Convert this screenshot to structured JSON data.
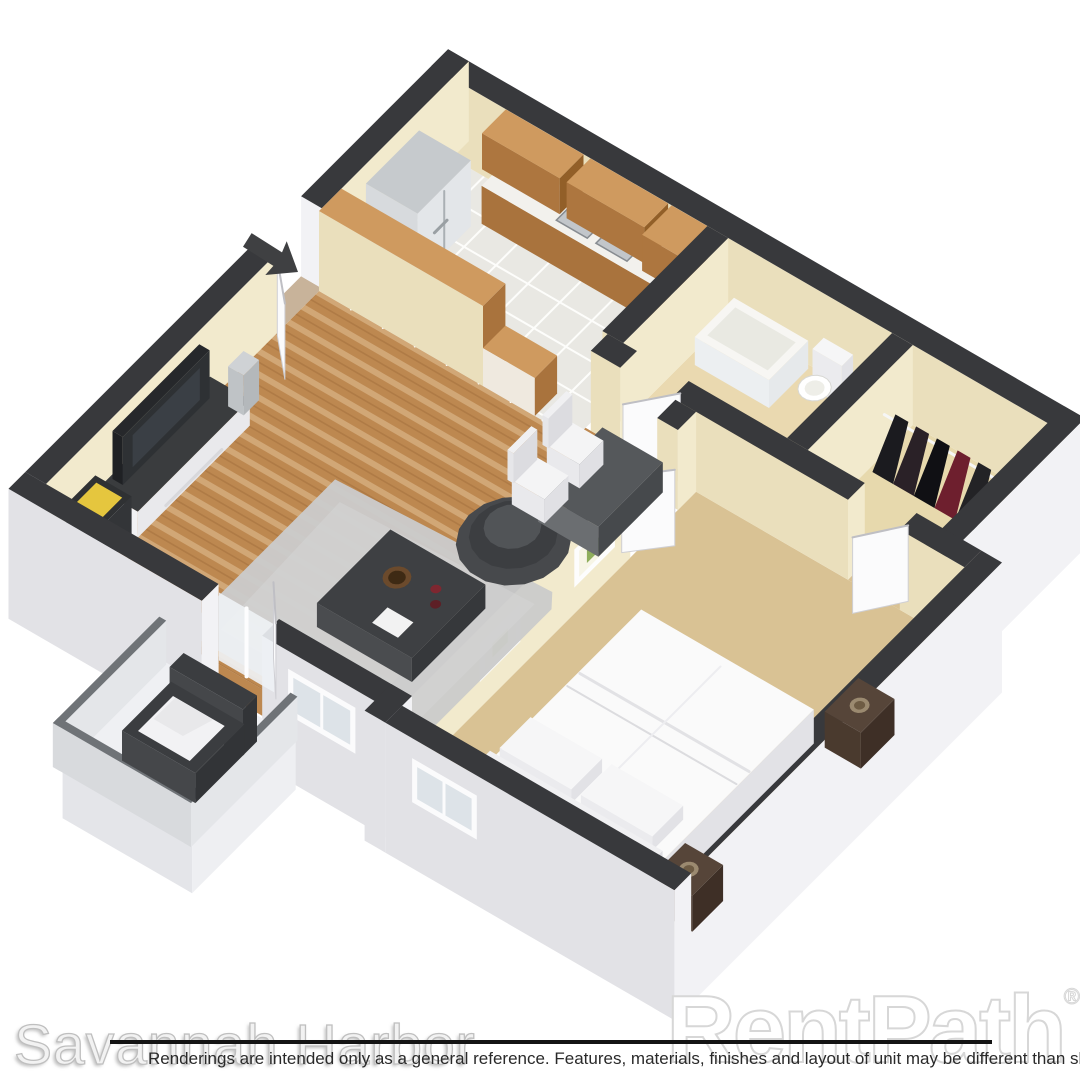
{
  "watermarks": {
    "property": "Savannah Harbor",
    "brand": "RentPath",
    "brand_mark": "®"
  },
  "disclaimer": "Renderings are intended only as a general reference. Features, materials, finishes and layout of unit may be different than shown.",
  "floorplan": {
    "type": "3d-isometric-floor-plan-rendering",
    "unit": "one-bedroom one-bath apartment",
    "rooms": [
      "kitchen",
      "dining-area",
      "living-room",
      "entry",
      "bathroom",
      "walk-in-closet",
      "bedroom",
      "balcony"
    ],
    "icons": [
      "entry-direction-arrow"
    ],
    "colors": {
      "background": "#ffffff",
      "wall_top": "#38393c",
      "wall_interior": "#eadfbc",
      "wall_interior_light": "#f2eacd",
      "wall_exterior": "#e2e2e6",
      "wall_exterior_light": "#f2f2f5",
      "wood_floor": "#bd8850",
      "tile_floor": "#e9e8e3",
      "bath_floor": "#ead9b0",
      "closet_floor": "#e7d9ad",
      "carpet": "#d9c294",
      "balcony_floor": "#eff0f3",
      "cabinet_wood": "#a9733d",
      "cabinet_wood_top": "#cf9a5f",
      "counter_top": "#f2f1ed",
      "appliance_steel": "#d7dadd",
      "dark_furniture": "#3d3f42",
      "rug": "#cbcbcb",
      "bedding": "#fafafa",
      "espresso": "#4a3a2e",
      "door_white": "#fbfbfc",
      "arrow": "#3f4042",
      "line_black": "#141414",
      "disclaimer_text": "#2a2a2a"
    }
  }
}
